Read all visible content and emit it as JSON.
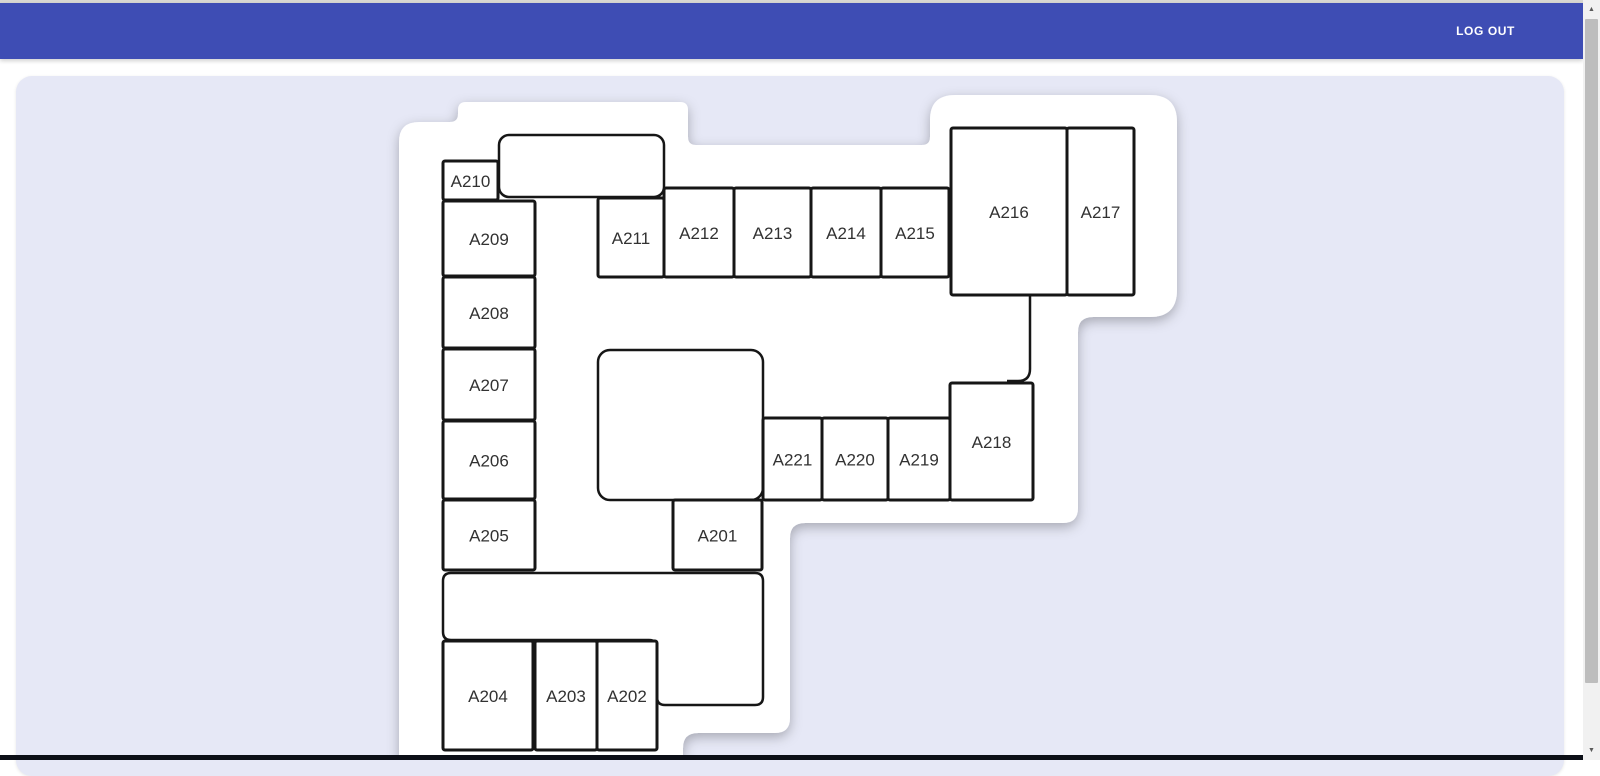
{
  "page": {
    "top_strip_color": "#d8d7d2",
    "bottom_bar_color": "#0c0f17",
    "background": "#ffffff"
  },
  "header": {
    "color": "#3e4db4",
    "logout_label": "LOG OUT"
  },
  "panel": {
    "color": "#e6e8f6"
  },
  "scrollbar": {
    "up_icon": "▲",
    "down_icon": "▼"
  },
  "floorplan": {
    "stroke_color": "#161616",
    "label_color": "#323232",
    "label_font_size": 17,
    "outline_path": "M 399,760 L 399,142 Q 399,122 419,122 L 450,122 Q 458,122 458,114 L 458,110 Q 458,102 466,102 L 680,102 Q 688,102 688,110 L 688,137 Q 688,145 696,145 L 922,145 Q 930,145 930,137 L 930,120 Q 930,95 955,95 L 1150,95 Q 1177,95 1177,122 L 1177,290 Q 1177,317 1150,317 L 1093,317 Q 1078,317 1078,332 L 1078,508 Q 1078,523 1063,523 L 805,523 Q 790,523 790,538 L 790,718 Q 790,733 775,733 L 698,733 Q 683,733 683,748 L 683,760 Z",
    "connector_path": "M 1030,296 L 1030,369 Q 1030,381 1018,381 L 1007,381",
    "rooms": [
      {
        "label": "A210",
        "x": 443,
        "y": 161,
        "w": 55,
        "h": 39
      },
      {
        "label": "A209",
        "x": 443,
        "y": 201,
        "w": 92,
        "h": 75
      },
      {
        "label": "A208",
        "x": 443,
        "y": 277,
        "w": 92,
        "h": 71
      },
      {
        "label": "A207",
        "x": 443,
        "y": 349,
        "w": 92,
        "h": 71
      },
      {
        "label": "A206",
        "x": 443,
        "y": 421,
        "w": 92,
        "h": 78
      },
      {
        "label": "A205",
        "x": 443,
        "y": 500,
        "w": 92,
        "h": 70
      },
      {
        "label": "A204",
        "x": 443,
        "y": 641,
        "w": 90,
        "h": 109
      },
      {
        "label": "A203",
        "x": 535,
        "y": 641,
        "w": 62,
        "h": 109
      },
      {
        "label": "A202",
        "x": 597,
        "y": 641,
        "w": 60,
        "h": 109
      },
      {
        "label": "A211",
        "x": 598,
        "y": 198,
        "w": 66,
        "h": 79
      },
      {
        "label": "A212",
        "x": 664,
        "y": 188,
        "w": 70,
        "h": 89
      },
      {
        "label": "A213",
        "x": 734,
        "y": 188,
        "w": 77,
        "h": 89
      },
      {
        "label": "A214",
        "x": 811,
        "y": 188,
        "w": 70,
        "h": 89
      },
      {
        "label": "A215",
        "x": 881,
        "y": 188,
        "w": 68,
        "h": 89
      },
      {
        "label": "A216",
        "x": 951,
        "y": 128,
        "w": 116,
        "h": 167
      },
      {
        "label": "A217",
        "x": 1067,
        "y": 128,
        "w": 67,
        "h": 167
      },
      {
        "label": "A221",
        "x": 763,
        "y": 418,
        "w": 59,
        "h": 82
      },
      {
        "label": "A220",
        "x": 822,
        "y": 418,
        "w": 66,
        "h": 82
      },
      {
        "label": "A219",
        "x": 888,
        "y": 418,
        "w": 62,
        "h": 82
      },
      {
        "label": "A218",
        "x": 950,
        "y": 383,
        "w": 83,
        "h": 117
      },
      {
        "label": "A201",
        "x": 673,
        "y": 500,
        "w": 89,
        "h": 70
      }
    ],
    "shapes": [
      {
        "name": "room-unlabeled-top",
        "type": "rect",
        "x": 499,
        "y": 135,
        "w": 165,
        "h": 62,
        "r": 10
      },
      {
        "name": "room-unlabeled-middle",
        "type": "rect",
        "x": 598,
        "y": 350,
        "w": 165,
        "h": 150,
        "r": 12
      },
      {
        "name": "room-unlabeled-bottom-L",
        "type": "path",
        "d": "M 451,573 L 755,573 Q 763,573 763,581 L 763,697 Q 763,705 755,705 L 665,705 Q 657,705 657,697 L 657,648 Q 657,640 649,640 L 451,640 Q 443,640 443,632 L 443,581 Q 443,573 451,573 Z"
      }
    ]
  }
}
